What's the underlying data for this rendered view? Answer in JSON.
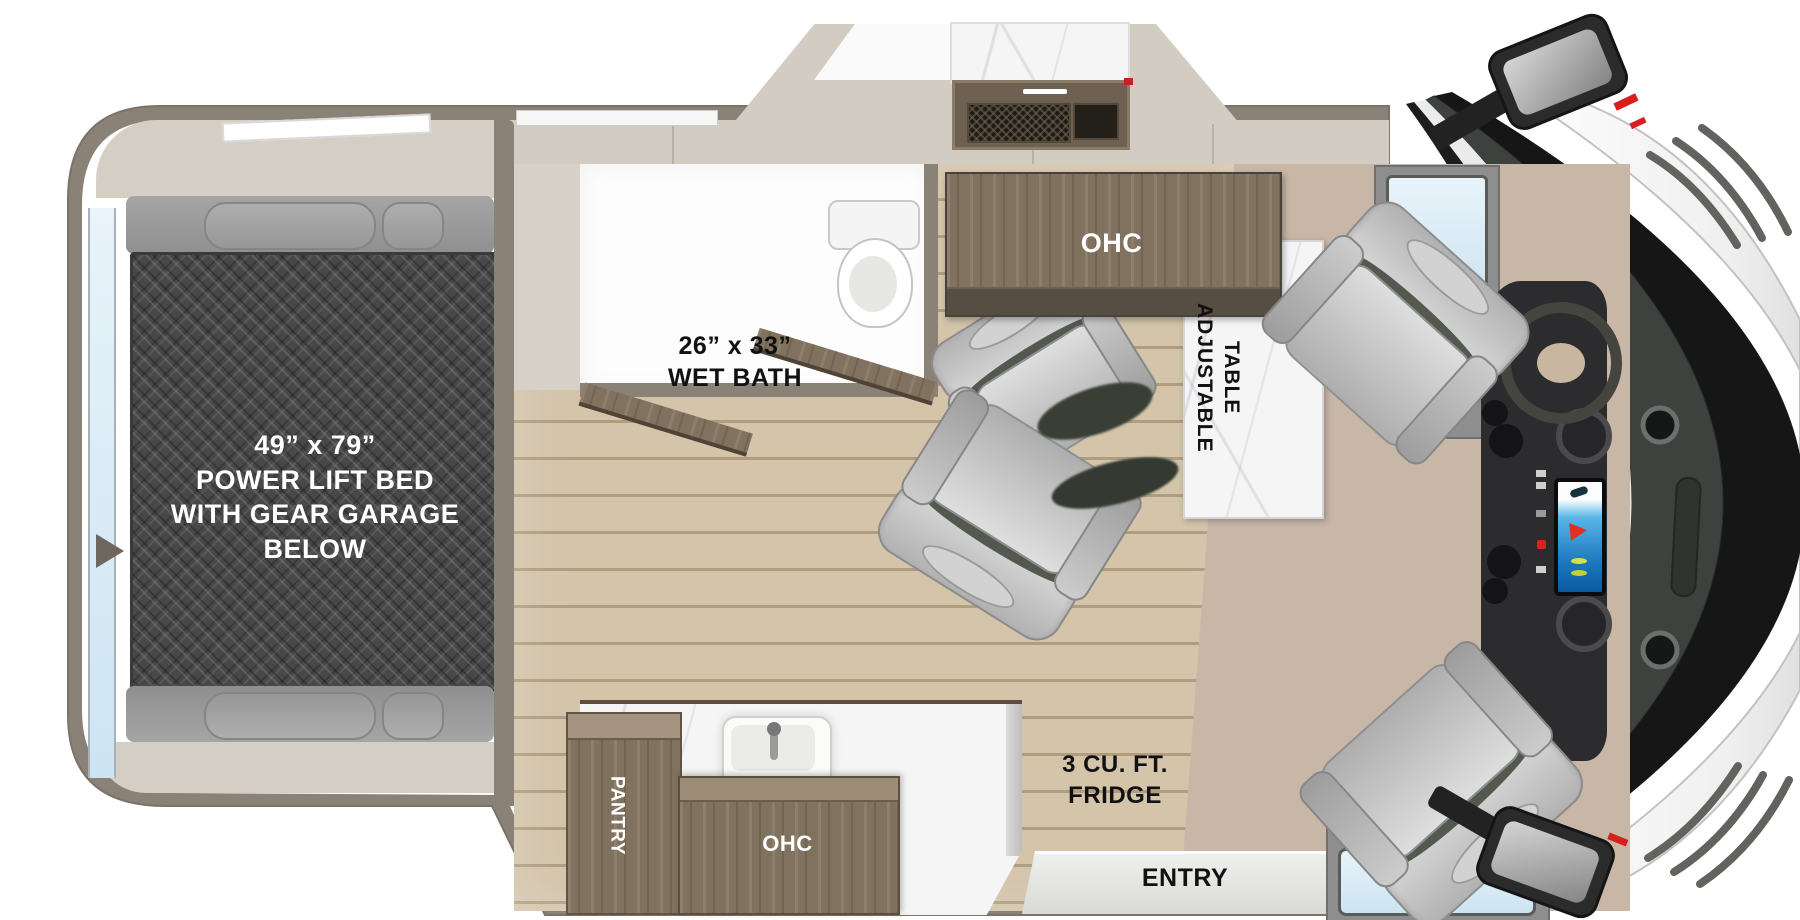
{
  "labels": {
    "bed": {
      "dimensions": "49” x 79”",
      "line1": "POWER LIFT BED",
      "line2": "WITH GEAR GARAGE BELOW"
    },
    "wet_bath": {
      "dimensions": "26” x 33”",
      "name": "WET BATH"
    },
    "dinette_ohc": "OHC",
    "table": {
      "line1": "ADJUSTABLE",
      "line2": "TABLE"
    },
    "pantry": "PANTRY",
    "galley_ohc": "OHC",
    "fridge": {
      "line1": "3 CU. FT.",
      "line2": "FRIDGE"
    },
    "entry": "ENTRY"
  },
  "colors": {
    "body_wall": "#8b8277",
    "bed_plate": "#484848",
    "wood_floor": "#c9b89d",
    "cabinet_wood": "#81725f",
    "counter_marble": "#f5f5f6",
    "carpet": "#c8b7a7",
    "beige_trim": "#d3ccc3",
    "window_glass": "#d7e9f4",
    "seat_gray": "#c2c2c2",
    "screen_blue": "#1e78c0",
    "accent_red": "#d81f1f"
  }
}
